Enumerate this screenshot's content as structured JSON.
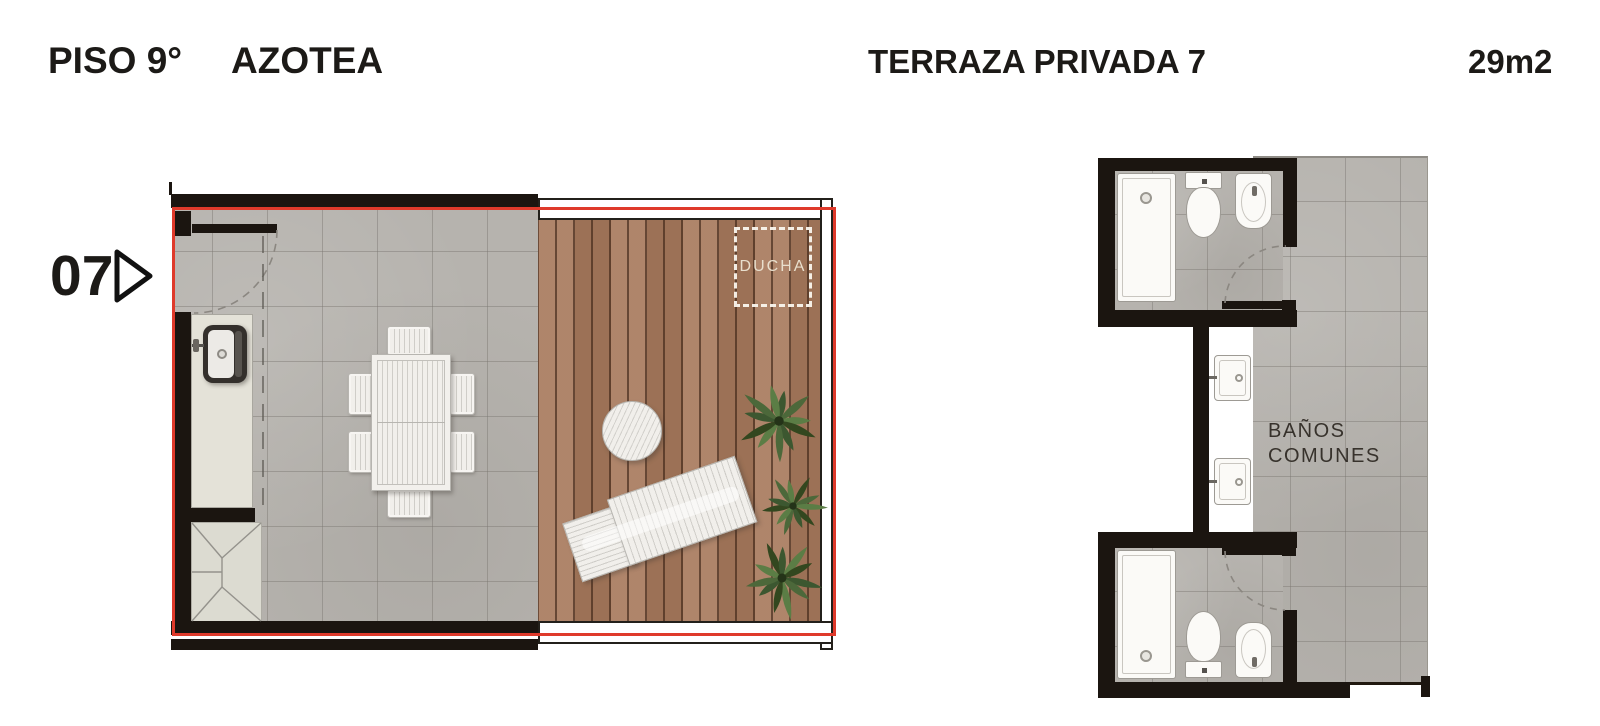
{
  "header": {
    "floor_label": "PISO 9°",
    "floor_sublabel": "AZOTEA",
    "plan_title": "TERRAZA PRIVADA 7",
    "area_label": "29m2"
  },
  "unit_marker": {
    "number": "07",
    "arrow_icon": "triangle-right-outline"
  },
  "terrace_plan": {
    "shower_label": "DUCHA",
    "fixtures": [
      "kitchen-counter",
      "kitchen-sink",
      "service-shaft",
      "dining-table-six-chairs",
      "round-side-table",
      "sun-lounger",
      "plants",
      "wood-deck",
      "tile-floor",
      "door-swing",
      "shower-zone-dashed",
      "glass-railing"
    ]
  },
  "common_baths_plan": {
    "label_line1": "BAÑOS",
    "label_line2": "COMUNES",
    "fixtures": [
      "shower-tray",
      "toilet",
      "bidet",
      "wash-basin",
      "wash-basin",
      "toilet",
      "bidet",
      "shower-tray",
      "door-swing",
      "door-swing"
    ]
  },
  "colors": {
    "wall_black": "#1b1510",
    "outline_red": "#df3a2b",
    "tile_gray": "#b6b3ae",
    "deck_wood": "#a87b5e",
    "counter_beige": "#e4e2d8",
    "fixture_white": "#fbfaf7",
    "plant_green": "#4c683a",
    "title_text": "#1c1a17",
    "ducha_text": "#e9dfcd",
    "plan_label_text": "#37322c"
  }
}
